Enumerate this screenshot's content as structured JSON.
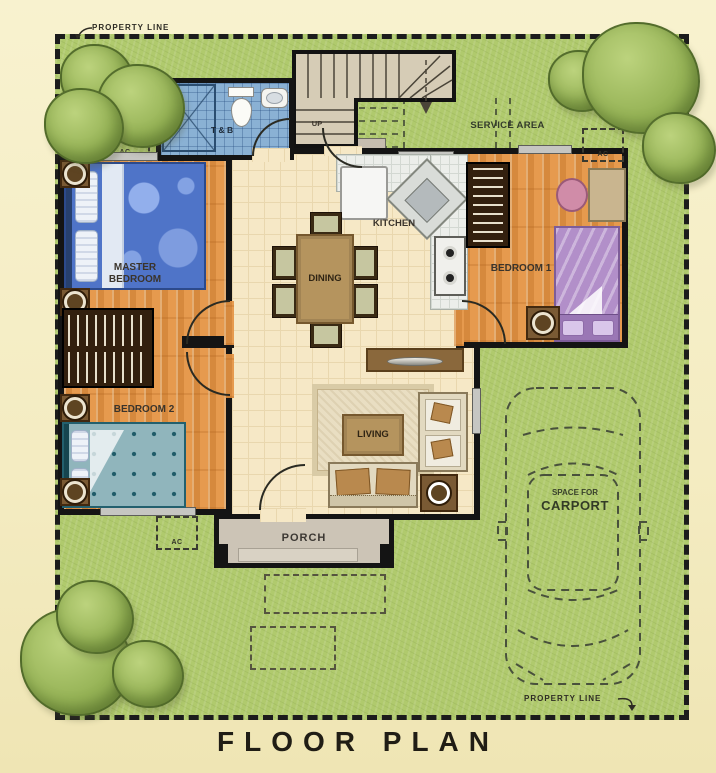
{
  "title": "FLOOR PLAN",
  "property_line": {
    "top": "PROPERTY LINE",
    "bottom": "PROPERTY LINE"
  },
  "rooms": {
    "master_line1": "MASTER",
    "master_line2": "BEDROOM",
    "bedroom1": "BEDROOM 1",
    "bedroom2": "BEDROOM 2",
    "kitchen": "KITCHEN",
    "dining": "DINING",
    "living": "LIVING",
    "toilet_bath": "T & B",
    "porch": "PORCH",
    "service_area": "SERVICE AREA",
    "stairs_up": "UP",
    "ac_unit": "AC",
    "carport_line1": "SPACE FOR",
    "carport_line2": "CARPORT"
  },
  "colors": {
    "background": "#f5eec6",
    "lawn": "#b0ca6d",
    "tree": "#96b356",
    "wall": "#141414",
    "wood_floor": "#e69a4e",
    "tile_floor": "#f6e8c6",
    "bath_tile": "#8ab1d4",
    "porch_concrete": "#ccc4b6",
    "master_bed": "#4f74c8",
    "bedroom1_bed": "#b28fc9",
    "bedroom2_bed": "#90b5bc",
    "furniture_wood": "#b5945e"
  }
}
